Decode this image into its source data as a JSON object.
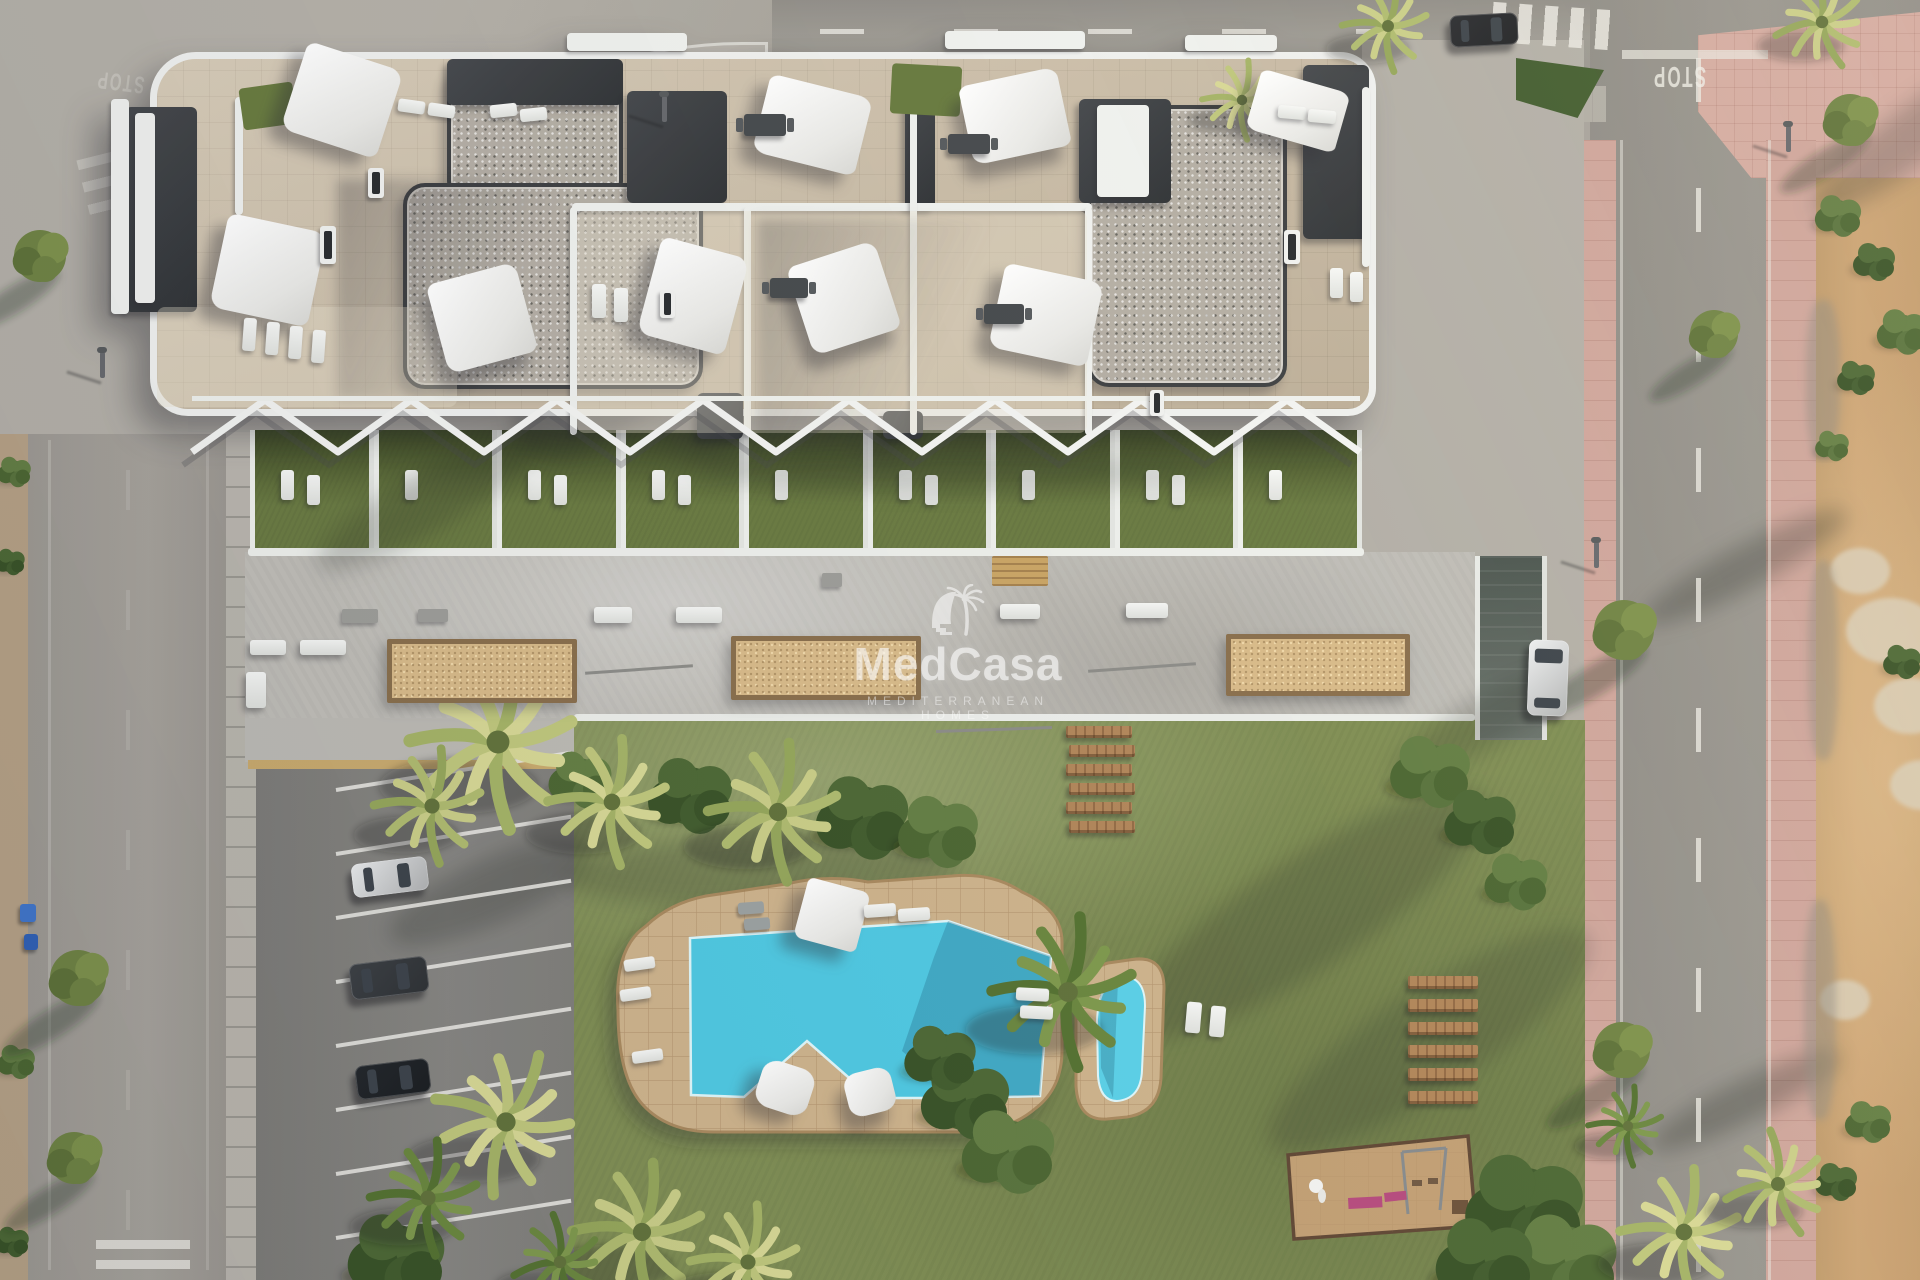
{
  "meta": {
    "description": "Aerial 3D architectural rendering of a Mediterranean apartment complex with rooftop terraces, communal garden, swimming pool, kids pool, playground and parking",
    "canvas": {
      "w": 1920,
      "h": 1280
    }
  },
  "watermark": {
    "brand": "MedCasa",
    "tagline": "MEDITERRANEAN HOMES",
    "logo": "palm-tree-arch-logo",
    "color": "#ffffff"
  },
  "road_markings": {
    "stop": "STOP"
  },
  "palette": {
    "pool_water": "#4cc8e2",
    "pool_water_shadow": "#2e8fb4",
    "pool_deck": "#cdb28a",
    "grass": "#7e8d52",
    "plot_grass": "#68793f",
    "stone_roof": "#c9bba4",
    "gravel_roof": "#b3ada3",
    "terrace_concrete": "#bebcb6",
    "asphalt": "#96938c",
    "pink_sidewalk": "#cea49a",
    "dirt": "#c49c6c",
    "planter_sand": "#d7b987",
    "white_wall": "#eff0ee",
    "charcoal": "#34373a",
    "wood": "#b08457"
  },
  "scene": {
    "pergola": {
      "x0": 192,
      "x1": 1360,
      "ytop": 400,
      "ybot": 452,
      "period": 146
    },
    "plots": {
      "x0": 250,
      "count": 9,
      "w": 123.5,
      "h": 122,
      "loungers_per_plot": [
        2,
        1,
        2,
        2,
        1,
        2,
        1,
        2,
        1
      ]
    },
    "pool": {
      "deck_path": "M 618,1010 Q 614,948 646,926 Q 670,903 706,896 L 786,884 Q 828,874 868,882 L 952,876 Q 992,872 1022,892 Q 1062,910 1062,942 L 1062,1050 Q 1062,1088 1036,1108 Q 1008,1132 966,1132 L 714,1132 Q 668,1132 643,1105 Q 618,1078 618,1010 Z",
      "water_path": "M 690,938 L 948,921 L 1051,956 L 1040,1096 L 956,1098 L 872,1098 L 807,1041 L 744,1097 L 691,1095 Z",
      "water_shadow_path": "M 948,921 L 1051,956 L 1040,1096 L 955,1097 L 902,1051 L 934,957 Z",
      "kids_deck_path": "M 1076,1018 Q 1076,972 1108,963 L 1136,959 Q 1164,957 1164,988 L 1161,1078 Q 1159,1112 1127,1117 L 1107,1119 Q 1078,1121 1076,1086 Z",
      "kids_water_path": "M 1097,1020 Q 1099,982 1121,977 Q 1145,975 1145,1006 L 1142,1070 Q 1141,1099 1117,1101 Q 1100,1101 1098,1076 Z",
      "kids_shadow_path": "M 1100,995 L 1118,981 L 1113,1098 L 1101,1068 Z"
    },
    "playground": {
      "outline": "1288,1155 1468,1136 1476,1226 1294,1239",
      "swing_posts": [
        [
          1402,
          1152,
          1408,
          1214
        ],
        [
          1446,
          1148,
          1440,
          1210
        ]
      ],
      "swing_bar": [
        1402,
        1152,
        1446,
        1148
      ],
      "swing_seats": [
        [
          1412,
          1180
        ],
        [
          1428,
          1178
        ]
      ],
      "pink_benches": [
        [
          1348,
          1198,
          34,
          11,
          -3
        ],
        [
          1384,
          1193,
          22,
          9,
          -6
        ]
      ],
      "sculpture": [
        1316,
        1186
      ],
      "sand_box": [
        1452,
        1200,
        16,
        14
      ]
    },
    "steps": {
      "x": 1066,
      "y0": 726,
      "dy": 19,
      "count": 6,
      "w": 66,
      "h": 12
    },
    "wood_benches": {
      "x": 1408,
      "y0": 976,
      "dy": 23,
      "count": 6,
      "w": 70,
      "h": 13
    },
    "parking_lines": {
      "x": 336,
      "y0": 788,
      "dy": 64,
      "count": 8,
      "len": 238,
      "rot": -9
    },
    "sails_xywhr": [
      [
        292,
        54,
        100,
        92,
        18
      ],
      [
        760,
        85,
        105,
        80,
        14
      ],
      [
        965,
        76,
        100,
        80,
        -12
      ],
      [
        1252,
        80,
        92,
        62,
        16
      ],
      [
        218,
        222,
        100,
        96,
        12
      ],
      [
        436,
        272,
        92,
        92,
        -15
      ],
      [
        648,
        246,
        90,
        100,
        15
      ],
      [
        798,
        252,
        92,
        92,
        -18
      ],
      [
        996,
        272,
        100,
        86,
        12
      ],
      [
        800,
        884,
        64,
        62,
        15
      ]
    ],
    "pillows_xywhr": [
      [
        758,
        1064,
        54,
        48,
        18
      ],
      [
        846,
        1070,
        48,
        44,
        -14
      ]
    ],
    "loungers_xywhr": [
      [
        398,
        100,
        27,
        13,
        8
      ],
      [
        428,
        104,
        27,
        13,
        8
      ],
      [
        490,
        104,
        27,
        13,
        -6
      ],
      [
        520,
        108,
        27,
        13,
        -6
      ],
      [
        243,
        318,
        13,
        33,
        4
      ],
      [
        266,
        322,
        13,
        33,
        4
      ],
      [
        289,
        326,
        13,
        33,
        4
      ],
      [
        312,
        330,
        13,
        33,
        4
      ],
      [
        592,
        284,
        14,
        34,
        0
      ],
      [
        614,
        288,
        14,
        34,
        0
      ],
      [
        1278,
        106,
        28,
        13,
        5
      ],
      [
        1308,
        110,
        28,
        13,
        5
      ],
      [
        1330,
        268,
        13,
        30,
        0
      ],
      [
        1350,
        272,
        13,
        30,
        0
      ],
      [
        864,
        904,
        32,
        13,
        -4
      ],
      [
        898,
        908,
        32,
        13,
        -4
      ],
      [
        1016,
        988,
        33,
        13,
        3
      ],
      [
        1020,
        1006,
        33,
        13,
        3
      ],
      [
        624,
        958,
        31,
        12,
        -8
      ],
      [
        620,
        988,
        31,
        12,
        -8
      ],
      [
        632,
        1050,
        31,
        12,
        -8
      ],
      [
        1186,
        1002,
        15,
        31,
        5
      ],
      [
        1210,
        1006,
        15,
        31,
        5
      ]
    ],
    "gray_loungers_xywhr": [
      [
        738,
        902,
        26,
        12,
        -4
      ],
      [
        744,
        918,
        26,
        12,
        -4
      ]
    ],
    "tables_xywh": [
      [
        744,
        114,
        42,
        22
      ],
      [
        948,
        134,
        42,
        20
      ],
      [
        770,
        278,
        38,
        20
      ],
      [
        984,
        304,
        40,
        20
      ]
    ],
    "skylights_xywh": [
      [
        368,
        168,
        16,
        30
      ],
      [
        320,
        226,
        16,
        38
      ],
      [
        1284,
        230,
        16,
        34
      ],
      [
        660,
        290,
        15,
        28
      ],
      [
        1150,
        390,
        14,
        26
      ]
    ],
    "benches_xywh": [
      [
        250,
        640,
        36,
        15
      ],
      [
        300,
        640,
        46,
        15
      ],
      [
        594,
        607,
        38,
        16
      ],
      [
        676,
        607,
        46,
        16
      ],
      [
        1000,
        604,
        40,
        15
      ],
      [
        1126,
        603,
        42,
        15
      ],
      [
        246,
        672,
        20,
        36
      ]
    ],
    "gray_boxes_xywh": [
      [
        342,
        609,
        36,
        14
      ],
      [
        418,
        609,
        30,
        13
      ],
      [
        822,
        573,
        20,
        14
      ]
    ],
    "wood_table_xywh": [
      992,
      556,
      56,
      30
    ],
    "rails_xywr": [
      [
        585,
        668,
        108,
        -4
      ],
      [
        1088,
        666,
        108,
        -4
      ],
      [
        936,
        728,
        116,
        -2
      ]
    ],
    "planters_xywh": [
      [
        387,
        639,
        190,
        64
      ],
      [
        731,
        636,
        190,
        64
      ],
      [
        1226,
        634,
        184,
        62
      ]
    ],
    "cars": [
      [
        352,
        860,
        76,
        34,
        -7,
        "#e9ebec",
        "h"
      ],
      [
        350,
        960,
        78,
        36,
        -7,
        "#3a3e42",
        "h"
      ],
      [
        356,
        1062,
        74,
        34,
        -7,
        "#202428",
        "h"
      ],
      [
        1528,
        640,
        40,
        76,
        2,
        "#edeff0",
        "v"
      ],
      [
        1450,
        14,
        68,
        32,
        -3,
        "#27292d",
        "h"
      ]
    ],
    "bins_xywhc": [
      [
        20,
        904,
        16,
        18,
        "#3f74c9"
      ],
      [
        24,
        934,
        14,
        16,
        "#2e5fb3"
      ]
    ],
    "lamps_xy": [
      [
        100,
        352
      ],
      [
        1594,
        542
      ],
      [
        1786,
        126
      ],
      [
        662,
        96
      ]
    ],
    "crosswalks": [
      [
        1492,
        6,
        118,
        40,
        90,
        13,
        13,
        4,
        0.85
      ],
      [
        82,
        148,
        96,
        58,
        0,
        10,
        13,
        -14,
        0.45
      ],
      [
        248,
        212,
        108,
        48,
        0,
        10,
        13,
        -20,
        0.3
      ],
      [
        96,
        1240,
        94,
        38,
        0,
        9,
        11,
        0,
        0.8
      ]
    ],
    "dashes": [
      [
        820,
        29,
        640,
        5,
        90,
        44,
        90,
        0.8
      ],
      [
        1696,
        58,
        5,
        1222,
        0,
        44,
        86,
        0.8
      ],
      [
        126,
        470,
        4,
        800,
        0,
        40,
        80,
        0.15
      ]
    ],
    "edge_lines": [
      [
        1620,
        140,
        3,
        1140,
        0.5
      ],
      [
        1768,
        140,
        3,
        1140,
        0.5
      ],
      [
        48,
        440,
        3,
        830,
        0.25
      ],
      [
        206,
        440,
        3,
        830,
        0.2
      ],
      [
        1622,
        50,
        146,
        9,
        0.7
      ]
    ],
    "stop_marks": [
      [
        1652,
        68,
        180,
        17,
        1.7,
        0.8
      ],
      [
        96,
        74,
        187,
        15,
        1.6,
        0.32
      ]
    ],
    "shadow_blobs": [
      [
        430,
        170,
        470,
        180,
        -55,
        0.26
      ],
      [
        560,
        836,
        400,
        70,
        -2,
        0.22
      ],
      [
        1090,
        860,
        430,
        110,
        -33,
        0.24
      ],
      [
        1240,
        990,
        380,
        100,
        -33,
        0.2
      ],
      [
        380,
        860,
        220,
        64,
        -24,
        0.26
      ],
      [
        1630,
        545,
        230,
        44,
        -28,
        0.3
      ],
      [
        1640,
        1080,
        210,
        42,
        -26,
        0.3
      ],
      [
        1790,
        110,
        240,
        56,
        -38,
        0.26
      ],
      [
        300,
        470,
        260,
        60,
        -30,
        0.22
      ],
      [
        700,
        452,
        520,
        40,
        0,
        0.18
      ],
      [
        1380,
        700,
        200,
        50,
        -30,
        0.22
      ]
    ],
    "palms_xyrt": [
      [
        498,
        742,
        88,
        "gold"
      ],
      [
        432,
        806,
        58,
        "gold2"
      ],
      [
        612,
        802,
        64,
        "gold"
      ],
      [
        778,
        812,
        70,
        "gold2"
      ],
      [
        1068,
        992,
        76,
        "green"
      ],
      [
        506,
        1122,
        74,
        "gold"
      ],
      [
        428,
        1198,
        58,
        "green"
      ],
      [
        642,
        1232,
        70,
        "gold2"
      ],
      [
        748,
        1262,
        58,
        "gold"
      ],
      [
        560,
        1262,
        48,
        "green"
      ],
      [
        1388,
        26,
        46,
        "gold2"
      ],
      [
        1242,
        100,
        40,
        "gold"
      ],
      [
        1822,
        22,
        48,
        "gold2"
      ],
      [
        1684,
        1232,
        64,
        "gold"
      ],
      [
        1778,
        1184,
        54,
        "gold2"
      ],
      [
        1628,
        1126,
        40,
        "green"
      ]
    ],
    "bushes_xyrt": [
      [
        690,
        796,
        40,
        "dark"
      ],
      [
        862,
        818,
        44,
        "dark"
      ],
      [
        938,
        832,
        38,
        "mid"
      ],
      [
        580,
        780,
        30,
        "mid"
      ],
      [
        965,
        1100,
        42,
        "dark"
      ],
      [
        1008,
        1152,
        44,
        "mid"
      ],
      [
        940,
        1058,
        34,
        "dark"
      ],
      [
        1430,
        772,
        38,
        "mid"
      ],
      [
        1480,
        822,
        34,
        "dark"
      ],
      [
        1516,
        882,
        30,
        "mid"
      ],
      [
        1524,
        1208,
        56,
        "dark"
      ],
      [
        1564,
        1262,
        50,
        "mid"
      ],
      [
        1484,
        1262,
        46,
        "dark"
      ],
      [
        396,
        1258,
        46,
        "dark"
      ],
      [
        1838,
        216,
        22,
        "mid"
      ],
      [
        1874,
        262,
        20,
        "dark"
      ],
      [
        1902,
        332,
        24,
        "mid"
      ],
      [
        1856,
        378,
        18,
        "dark"
      ],
      [
        1832,
        446,
        16,
        "mid"
      ],
      [
        1902,
        662,
        18,
        "dark"
      ],
      [
        1868,
        1122,
        22,
        "mid"
      ],
      [
        1836,
        1182,
        20,
        "dark"
      ],
      [
        14,
        472,
        16,
        "mid"
      ],
      [
        10,
        562,
        14,
        "dark"
      ],
      [
        16,
        1062,
        18,
        "mid"
      ],
      [
        12,
        1242,
        16,
        "dark"
      ]
    ],
    "trees_xyr": [
      [
        40,
        256,
        26
      ],
      [
        78,
        978,
        28
      ],
      [
        74,
        1158,
        26
      ],
      [
        1624,
        630,
        30
      ],
      [
        1622,
        1050,
        28
      ],
      [
        1714,
        334,
        24
      ],
      [
        1850,
        120,
        26
      ]
    ],
    "rocks_xywh": [
      [
        1846,
        598,
        90,
        66
      ],
      [
        1874,
        678,
        72,
        56
      ],
      [
        1830,
        548,
        60,
        46
      ],
      [
        1890,
        760,
        66,
        50
      ],
      [
        1820,
        980,
        50,
        40
      ]
    ],
    "rubble_xywh": [
      [
        1806,
        300,
        34,
        160
      ],
      [
        1808,
        560,
        30,
        200
      ],
      [
        1804,
        900,
        32,
        220
      ]
    ],
    "green_triangle": {
      "x": 1516,
      "y": 58,
      "w": 88,
      "h": 60,
      "color": "#3f5a2c"
    },
    "building": {
      "origin": [
        150,
        52
      ],
      "gravel_xywh": [
        [
          290,
          4,
          176,
          140
        ],
        [
          246,
          124,
          300,
          206
        ],
        [
          930,
          46,
          200,
          282
        ]
      ],
      "charcoal_xywh": [
        [
          -32,
          48,
          72,
          205
        ],
        [
          290,
          0,
          176,
          46
        ],
        [
          470,
          32,
          100,
          112
        ],
        [
          748,
          26,
          30,
          124
        ],
        [
          922,
          40,
          92,
          104
        ],
        [
          1146,
          6,
          66,
          174
        ],
        [
          540,
          334,
          46,
          46
        ],
        [
          726,
          352,
          40,
          28
        ]
      ],
      "panels_xywh": [
        [
          940,
          46,
          52,
          92
        ],
        [
          -22,
          54,
          20,
          190
        ],
        [
          410,
          -26,
          120,
          18
        ],
        [
          788,
          -28,
          140,
          18
        ],
        [
          1028,
          -24,
          92,
          16
        ],
        [
          -46,
          40,
          18,
          215
        ]
      ],
      "walls_xywh": [
        [
          415,
          144,
          520,
          8
        ],
        [
          413,
          148,
          7,
          228
        ],
        [
          587,
          148,
          7,
          228
        ],
        [
          753,
          30,
          7,
          346
        ],
        [
          928,
          148,
          7,
          228
        ],
        [
          78,
          38,
          8,
          118
        ],
        [
          1205,
          28,
          8,
          180
        ]
      ],
      "greens_xywhr": [
        [
          84,
          26,
          54,
          42,
          -8
        ],
        [
          734,
          6,
          70,
          50,
          3
        ]
      ],
      "light_overlays_xywh": [
        [
          420,
          152,
          510,
          222
        ],
        [
          0,
          248,
          300,
          100
        ]
      ]
    }
  }
}
